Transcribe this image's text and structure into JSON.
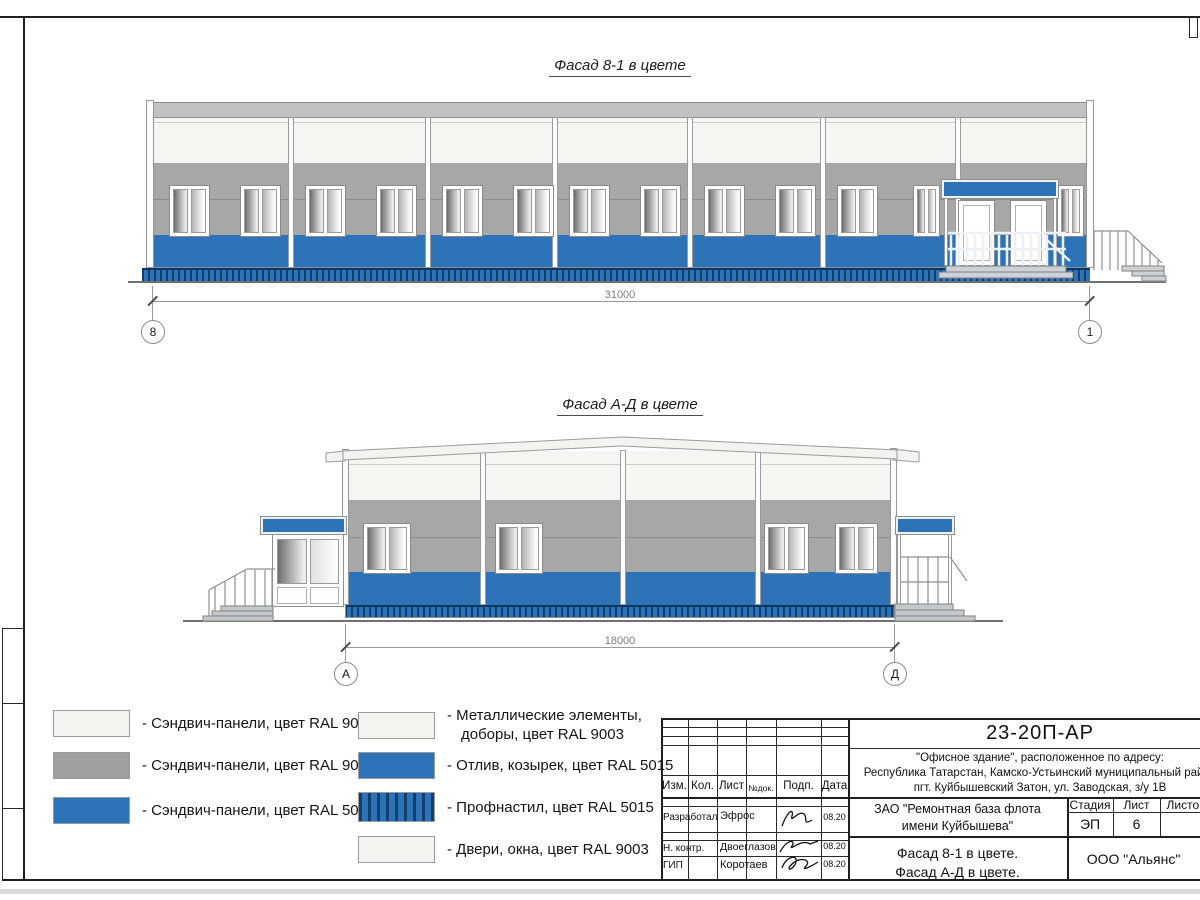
{
  "facade1": {
    "title": "Фасад 8-1 в цвете",
    "dim_label": "31000",
    "axis_left": "8",
    "axis_right": "1"
  },
  "facade2": {
    "title": "Фасад А-Д в цвете",
    "dim_label": "18000",
    "axis_left": "А",
    "axis_right": "Д"
  },
  "legend": {
    "left": [
      {
        "swatch": "white",
        "label": "- Сэндвич-панели, цвет RAL 9003"
      },
      {
        "swatch": "gray",
        "label": "- Сэндвич-панели, цвет RAL 9006"
      },
      {
        "swatch": "blue",
        "label": "- Сэндвич-панели, цвет RAL 5015"
      }
    ],
    "right": [
      {
        "swatch": "white",
        "label": "- Металлические элементы, доборы, цвет RAL 9003"
      },
      {
        "swatch": "blue",
        "label": "- Отлив, козырек, цвет RAL 5015"
      },
      {
        "swatch": "blue-striped",
        "label": "- Профнастил, цвет RAL 5015"
      },
      {
        "swatch": "white",
        "label": "- Двери, окна, цвет RAL 9003"
      }
    ]
  },
  "titleblock": {
    "doc_number": "23-20П-АР",
    "address_line1": "\"Офисное здание\", расположенное по адресу:",
    "address_line2": "Республика Татарстан, Камско-Устьинский муниципальный район",
    "address_line3": "пгт. Куйбышевский Затон, ул. Заводская, з/у 1В",
    "columns": {
      "izm": "Изм.",
      "kol": "Кол.",
      "list": "Лист",
      "doc": "№док.",
      "sign": "Подп.",
      "date": "Дата"
    },
    "signers": [
      {
        "role": "Разработал",
        "name": "Эфрос",
        "date": "08.20"
      },
      {
        "role": "Н. контр.",
        "name": "Двоеглазов",
        "date": "08.20"
      },
      {
        "role": "ГИП",
        "name": "Коротаев",
        "date": "08.20"
      }
    ],
    "client_line1": "ЗАО \"Ремонтная база флота",
    "client_line2": "имени Куйбышева\"",
    "stage_label": "Стадия",
    "sheet_label": "Лист",
    "sheets_label": "Листов",
    "stage_value": "ЭП",
    "sheet_value": "6",
    "drawing_title_line1": "Фасад 8-1 в цвете.",
    "drawing_title_line2": "Фасад А-Д в цвете.",
    "organization": "ООО \"Альянс\""
  },
  "colors": {
    "ral5015_blue": "#2d73b7",
    "ral9006_gray": "#a0a0a0",
    "ral9003_white": "#f2f5ef",
    "roof_gray": "#c2c2c2"
  }
}
